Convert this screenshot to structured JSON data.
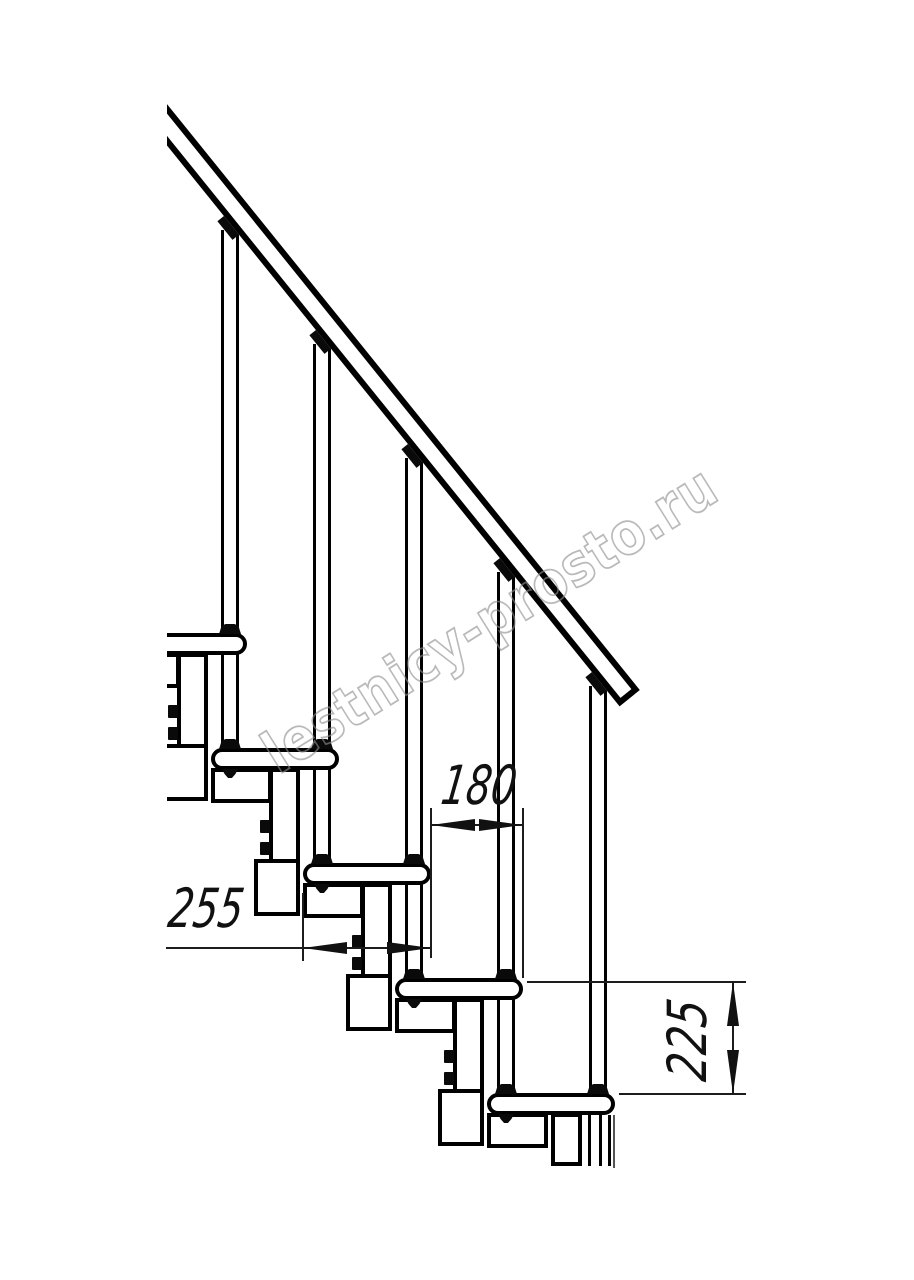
{
  "watermark": {
    "text": "lestnicy-prosto.ru"
  },
  "dimensions": {
    "step_run": "180",
    "tread_depth": "255",
    "step_height": "225"
  }
}
